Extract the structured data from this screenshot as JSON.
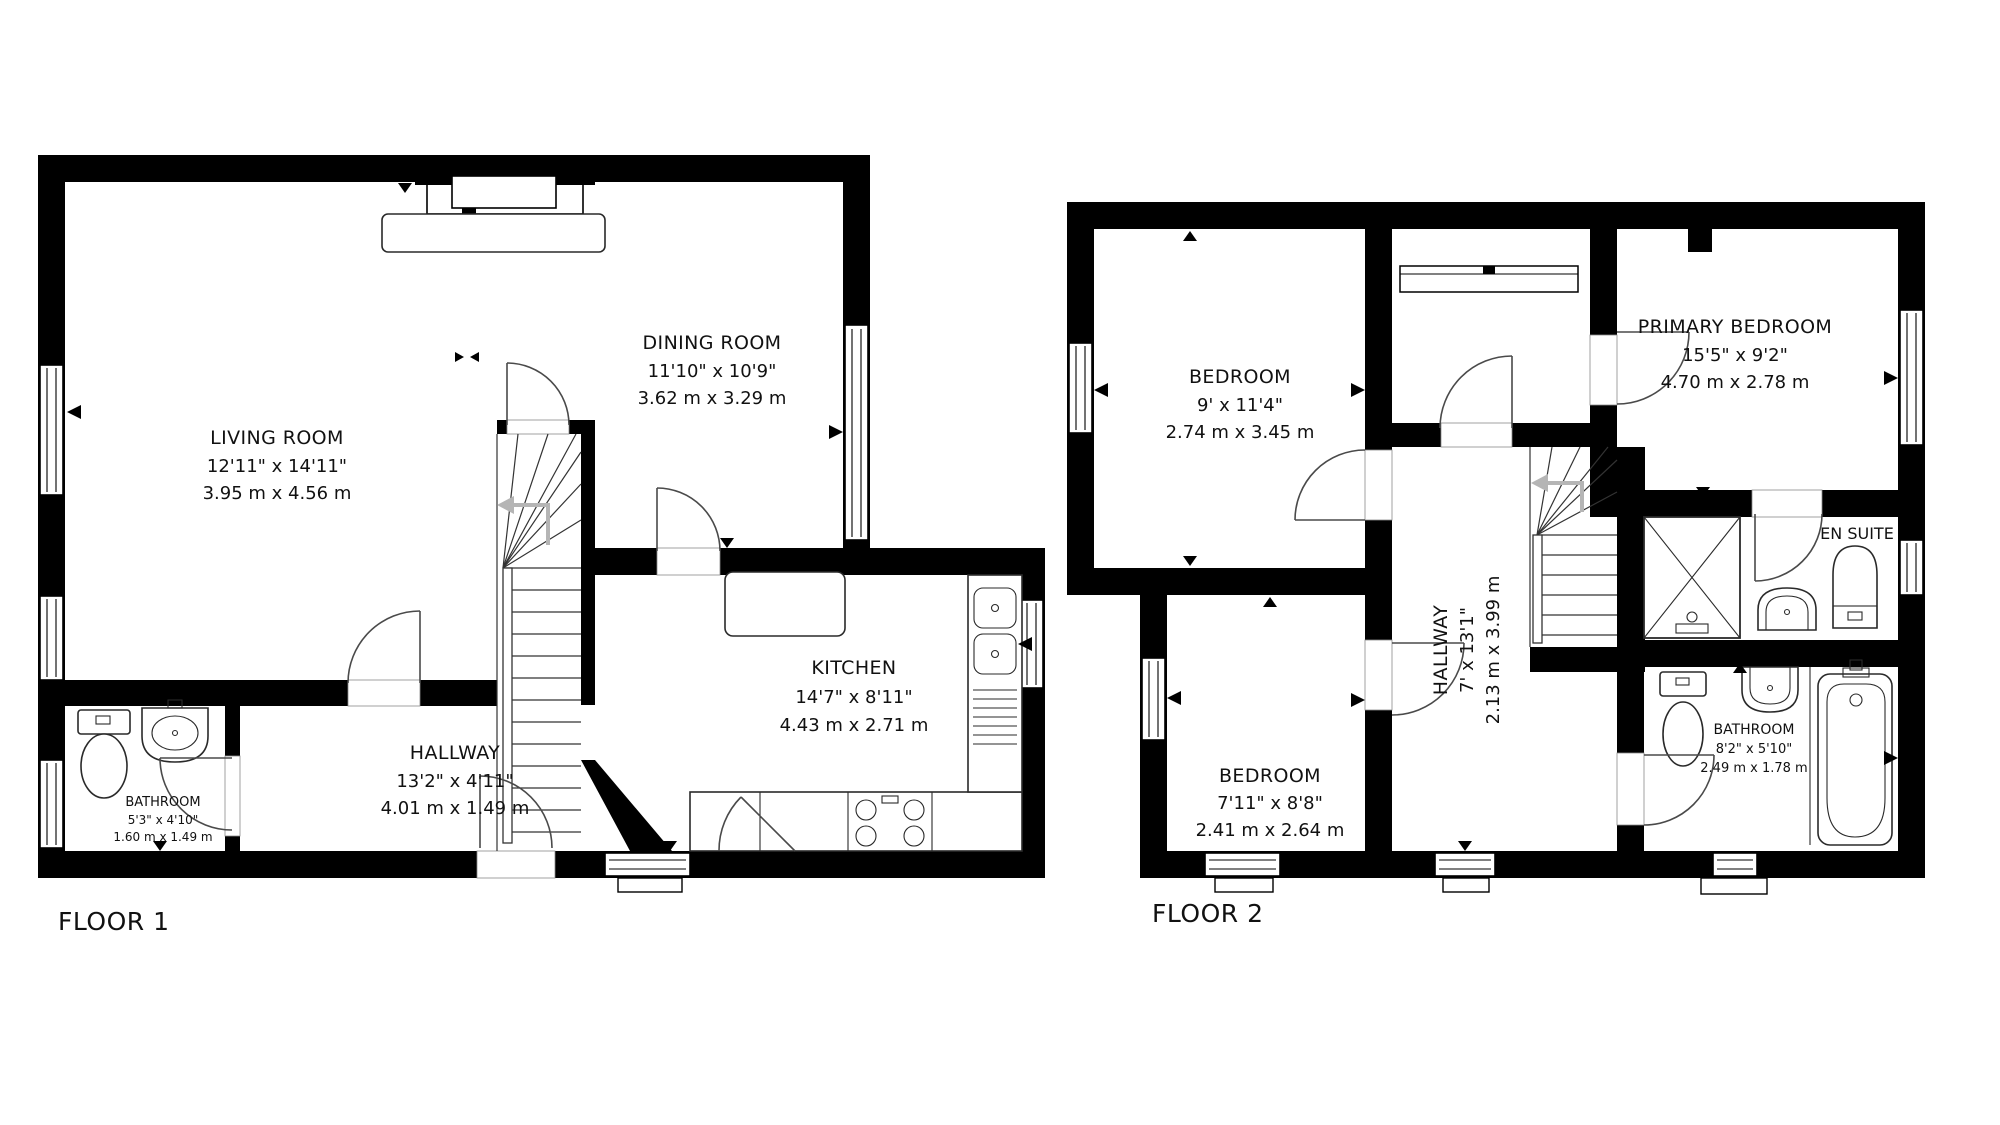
{
  "floor1": {
    "label": "FLOOR 1",
    "rooms": {
      "living": {
        "name": "LIVING ROOM",
        "imperial": "12'11\" x 14'11\"",
        "metric": "3.95 m x 4.56 m"
      },
      "dining": {
        "name": "DINING ROOM",
        "imperial": "11'10\" x 10'9\"",
        "metric": "3.62 m x 3.29 m"
      },
      "kitchen": {
        "name": "KITCHEN",
        "imperial": "14'7\" x 8'11\"",
        "metric": "4.43 m x 2.71 m"
      },
      "hallway": {
        "name": "HALLWAY",
        "imperial": "13'2\" x 4'11\"",
        "metric": "4.01 m x 1.49 m"
      },
      "bathroom": {
        "name": "BATHROOM",
        "imperial": "5'3\" x 4'10\"",
        "metric": "1.60 m x 1.49 m"
      }
    }
  },
  "floor2": {
    "label": "FLOOR 2",
    "rooms": {
      "bedroom_top": {
        "name": "BEDROOM",
        "imperial": "9' x 11'4\"",
        "metric": "2.74 m x 3.45 m"
      },
      "bedroom_bottom": {
        "name": "BEDROOM",
        "imperial": "7'11\" x 8'8\"",
        "metric": "2.41 m x 2.64 m"
      },
      "primary": {
        "name": "PRIMARY BEDROOM",
        "imperial": "15'5\" x 9'2\"",
        "metric": "4.70 m x 2.78 m"
      },
      "hallway": {
        "name": "HALLWAY",
        "imperial": "7' x 13'1\"",
        "metric": "2.13 m x 3.99 m"
      },
      "bathroom": {
        "name": "BATHROOM",
        "imperial": "8'2\" x 5'10\"",
        "metric": "2.49 m x 1.78 m"
      },
      "ensuite": {
        "name": "EN SUITE"
      }
    }
  },
  "colors": {
    "wall": "#000000",
    "background": "#ffffff",
    "door_stroke": "#4a4a4a",
    "stair_arrow": "#b5b5b5"
  }
}
